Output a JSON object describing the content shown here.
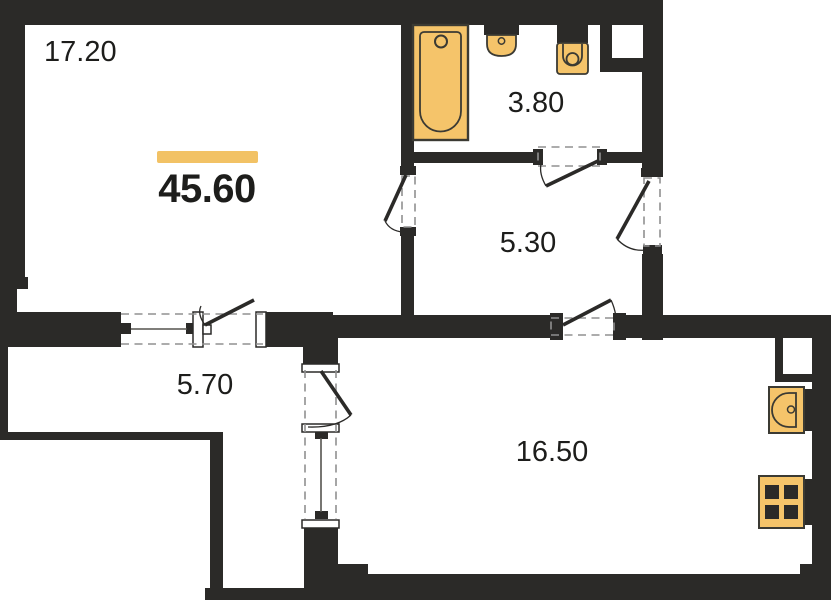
{
  "floor_plan": {
    "total_area_label": "45.60",
    "rooms": [
      {
        "name": "living-room",
        "area_label": "17.20"
      },
      {
        "name": "bathroom",
        "area_label": "3.80"
      },
      {
        "name": "inner-hall",
        "area_label": "5.30"
      },
      {
        "name": "entry-hall",
        "area_label": "5.70"
      },
      {
        "name": "kitchen-living-room",
        "area_label": "16.50"
      }
    ],
    "fixtures": [
      {
        "name": "bathtub"
      },
      {
        "name": "washbasin"
      },
      {
        "name": "toilet"
      },
      {
        "name": "kitchen-sink"
      },
      {
        "name": "stove"
      }
    ],
    "colors": {
      "wall": "#2b2a28",
      "fixture_fill": "#f5c46a",
      "fixture_outline": "#3b3a33",
      "accent_bar": "#f2c265",
      "dash": "#909090",
      "text": "#1d1d1b",
      "background": "#ffffff"
    }
  }
}
